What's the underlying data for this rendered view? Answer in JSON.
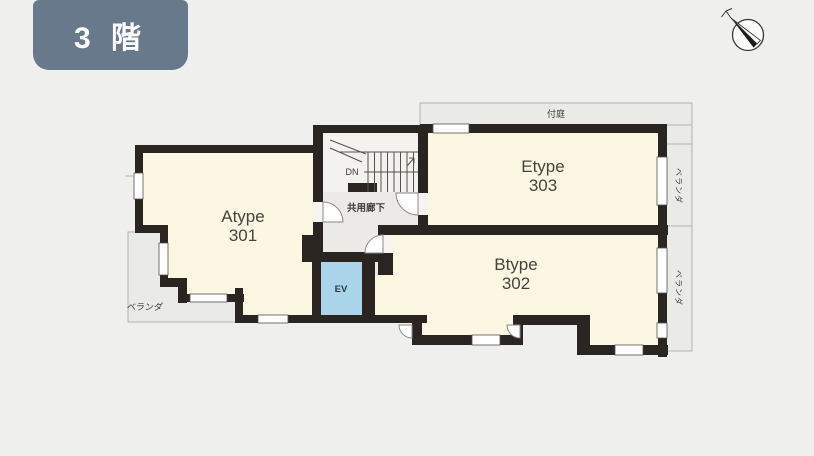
{
  "floor_badge": {
    "label": "3 階"
  },
  "rooms": [
    {
      "id": "atype",
      "name": "Atype",
      "number": "301"
    },
    {
      "id": "btype",
      "name": "Btype",
      "number": "302"
    },
    {
      "id": "etype",
      "name": "Etype",
      "number": "303"
    }
  ],
  "labels": {
    "elevator": "EV",
    "stairs_down": "DN",
    "shared_corridor": "共用廊下",
    "attached_garden": "付庭",
    "veranda_left": "ベランダ",
    "veranda_right_upper": "ベランダ",
    "veranda_right_lower": "ベランダ"
  },
  "colors": {
    "wall": "#2b2522",
    "room_fill": "#fbf7e3",
    "corridor_fill": "#ebeae7",
    "stair_fill": "#f3f2ef",
    "veranda_fill": "#eaeae7",
    "elevator_fill": "#a9d4ea",
    "badge_bg": "#68798b",
    "background": "#efefed"
  }
}
